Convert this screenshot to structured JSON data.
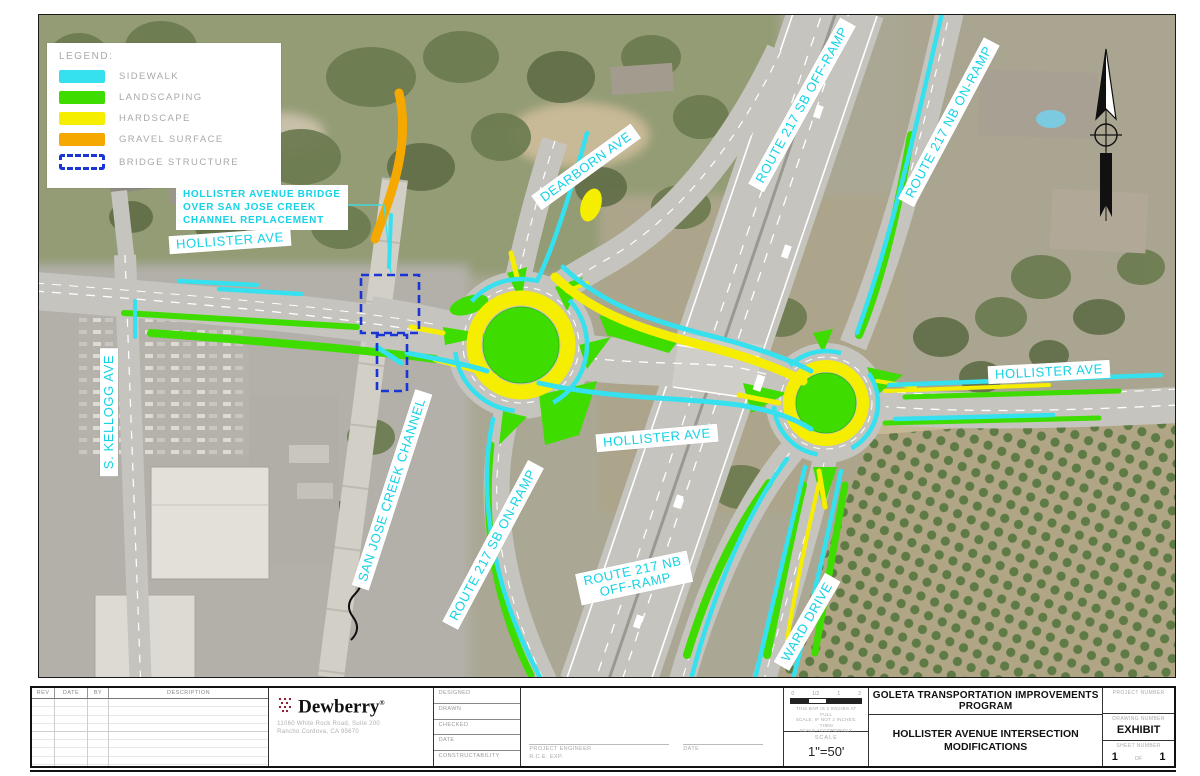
{
  "colors": {
    "sidewalk": "#35e1ee",
    "landscaping": "#3fdc00",
    "hardscape": "#f6ee00",
    "gravel": "#f5a800",
    "bridge_structure": "#1a35d6",
    "label_text": "#16d2e6"
  },
  "legend": {
    "title": "LEGEND:",
    "items": [
      {
        "name": "sidewalk",
        "label": "SIDEWALK",
        "color": "#35e1ee",
        "type": "fill"
      },
      {
        "name": "landscaping",
        "label": "LANDSCAPING",
        "color": "#3fdc00",
        "type": "fill"
      },
      {
        "name": "hardscape",
        "label": "HARDSCAPE",
        "color": "#f6ee00",
        "type": "fill"
      },
      {
        "name": "gravel-surface",
        "label": "GRAVEL  SURFACE",
        "color": "#f5a800",
        "type": "fill"
      },
      {
        "name": "bridge-structure",
        "label": "BRIDGE  STRUCTURE",
        "color": "#1a35d6",
        "type": "dashed-outline"
      }
    ]
  },
  "map": {
    "callout": {
      "lines": [
        "HOLLISTER AVENUE BRIDGE",
        "OVER SAN JOSE CREEK",
        "CHANNEL REPLACEMENT"
      ]
    },
    "labels": [
      {
        "name": "road-label-hollister-ave-west",
        "text": "HOLLISTER AVE",
        "x": 229,
        "y": 240,
        "rot": -4
      },
      {
        "name": "road-label-dearborn-ave",
        "text": "DEARBORN AVE",
        "x": 585,
        "y": 166,
        "rot": -36
      },
      {
        "name": "road-label-route-217-sb-off-ramp",
        "text": "ROUTE 217 SB OFF-RAMP",
        "x": 801,
        "y": 104,
        "rot": -61
      },
      {
        "name": "road-label-route-217-nb-on-ramp",
        "text": "ROUTE 217 NB ON-RAMP",
        "x": 948,
        "y": 121,
        "rot": -62
      },
      {
        "name": "road-label-s-kellogg-ave",
        "text": "S. KELLOGG AVE",
        "x": 108,
        "y": 411,
        "rot": -90
      },
      {
        "name": "road-label-san-jose-creek-channel",
        "text": "SAN JOSE CREEK CHANNEL",
        "x": 391,
        "y": 489,
        "rot": -72
      },
      {
        "name": "road-label-route-217-sb-on-ramp",
        "text": "ROUTE 217 SB ON-RAMP",
        "x": 492,
        "y": 544,
        "rot": -62
      },
      {
        "name": "road-label-hollister-ave-center",
        "text": "HOLLISTER AVE",
        "x": 656,
        "y": 437,
        "rot": -5
      },
      {
        "name": "road-label-route-217-nb-off-ramp",
        "text": "ROUTE 217 NB\nOFF-RAMP",
        "x": 633,
        "y": 577,
        "rot": -12
      },
      {
        "name": "road-label-ward-drive",
        "text": "WARD DRIVE",
        "x": 806,
        "y": 621,
        "rot": -60
      },
      {
        "name": "road-label-hollister-ave-east",
        "text": "HOLLISTER AVE",
        "x": 1048,
        "y": 371,
        "rot": -3
      }
    ]
  },
  "titleblock": {
    "revision_table": {
      "headers": [
        "REV",
        "DATE",
        "BY",
        "DESCRIPTION"
      ]
    },
    "firm": {
      "name": "Dewberry",
      "registered_mark": "®",
      "address_line1": "11060 White Rock Road, Suite 200",
      "address_line2": "Rancho Cordova, CA 95670"
    },
    "fields": [
      "DESIGNED",
      "DRAWN",
      "CHECKED",
      "DATE",
      "CONSTRUCTABILITY"
    ],
    "signature": {
      "project_engineer_label": "PROJECT ENGINEER",
      "rce_label": "R.C.E.         EXP.",
      "date_label": "DATE"
    },
    "scale": {
      "ticks": [
        "0",
        "1/2",
        "1",
        "2"
      ],
      "note_line1": "THIS BAR IS 2 INCHES AT FULL",
      "note_line2": "SCALE. IF NOT 2 INCHES, THEN",
      "note_line3": "SCALE ACCORDINGLY.",
      "label": "SCALE",
      "value": "1\"=50'"
    },
    "program_name": "GOLETA TRANSPORTATION IMPROVEMENTS PROGRAM",
    "sheet_title_line1": "HOLLISTER AVENUE INTERSECTION",
    "sheet_title_line2": "MODIFICATIONS",
    "project_number_label": "PROJECT NUMBER",
    "drawing_number_label": "DRAWING NUMBER",
    "drawing_number": "EXHIBIT",
    "sheet_number_label": "SHEET NUMBER",
    "sheet_number": "1",
    "sheet_of": "OF",
    "sheet_total": "1"
  }
}
